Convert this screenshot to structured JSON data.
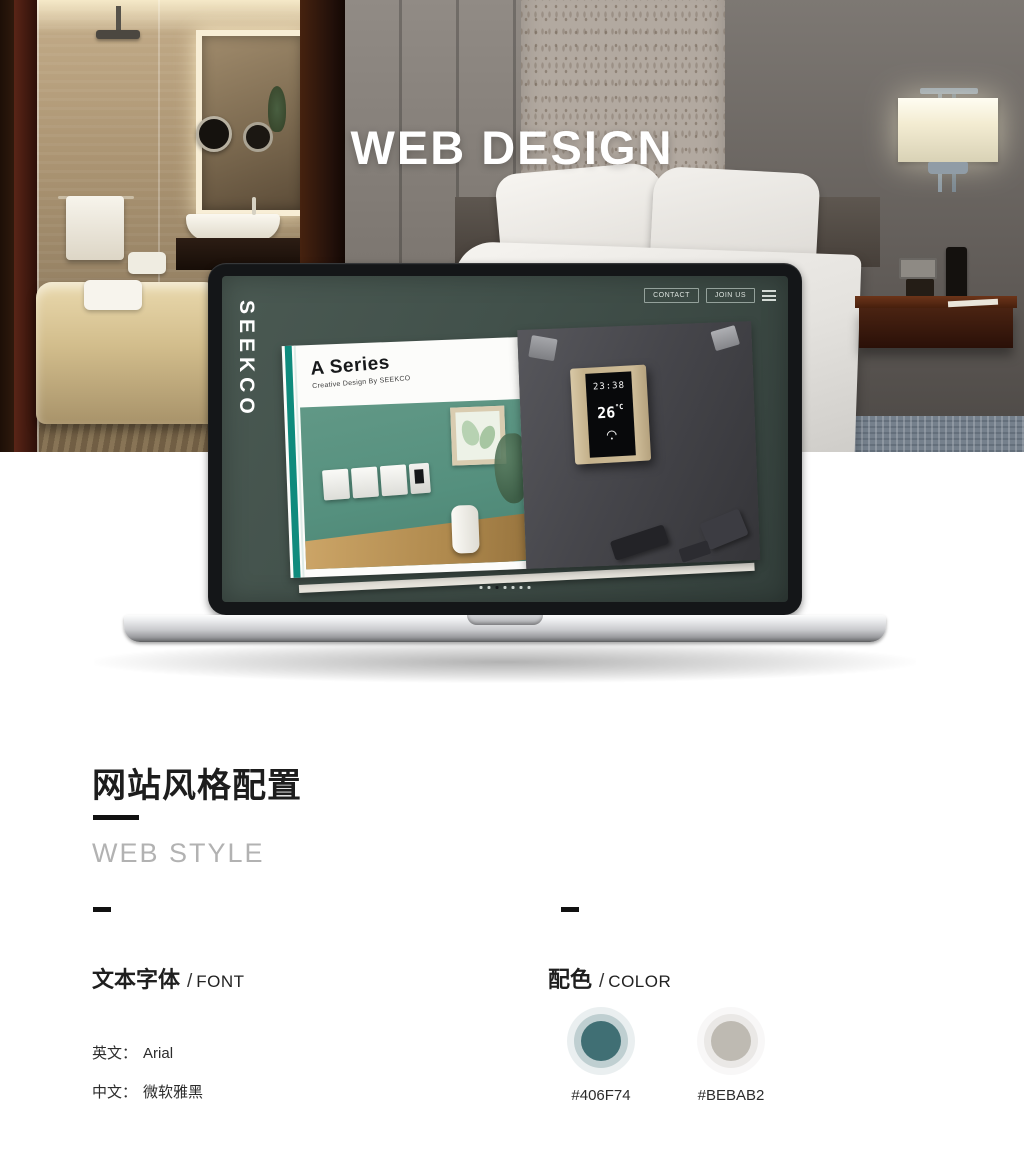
{
  "hero": {
    "title": "WEB DESIGN"
  },
  "laptop": {
    "brand": "SEEKCO",
    "nav": {
      "buttons": [
        "CONTACT",
        "JOIN US"
      ],
      "menu_icon": "hamburger-icon"
    },
    "catalog": {
      "title": "A Series",
      "subtitle": "Creative Design By SEEKCO",
      "thermostat": {
        "time": "23:38",
        "temp": "26",
        "unit": "°C"
      }
    },
    "pagination": {
      "count": 7,
      "active_index": 2
    }
  },
  "style_section": {
    "title_cn": "网站风格配置",
    "subtitle_en": "WEB STYLE",
    "font_block": {
      "heading_cn": "文本字体",
      "separator": "/",
      "heading_en": "FONT",
      "items": [
        {
          "label": "英文：",
          "value": "Arial"
        },
        {
          "label": "中文：",
          "value": "微软雅黑"
        }
      ]
    },
    "color_block": {
      "heading_cn": "配色",
      "separator": "/",
      "heading_en": "COLOR",
      "swatches": [
        {
          "hex": "#406F74"
        },
        {
          "hex": "#BEBAB2"
        }
      ]
    }
  }
}
